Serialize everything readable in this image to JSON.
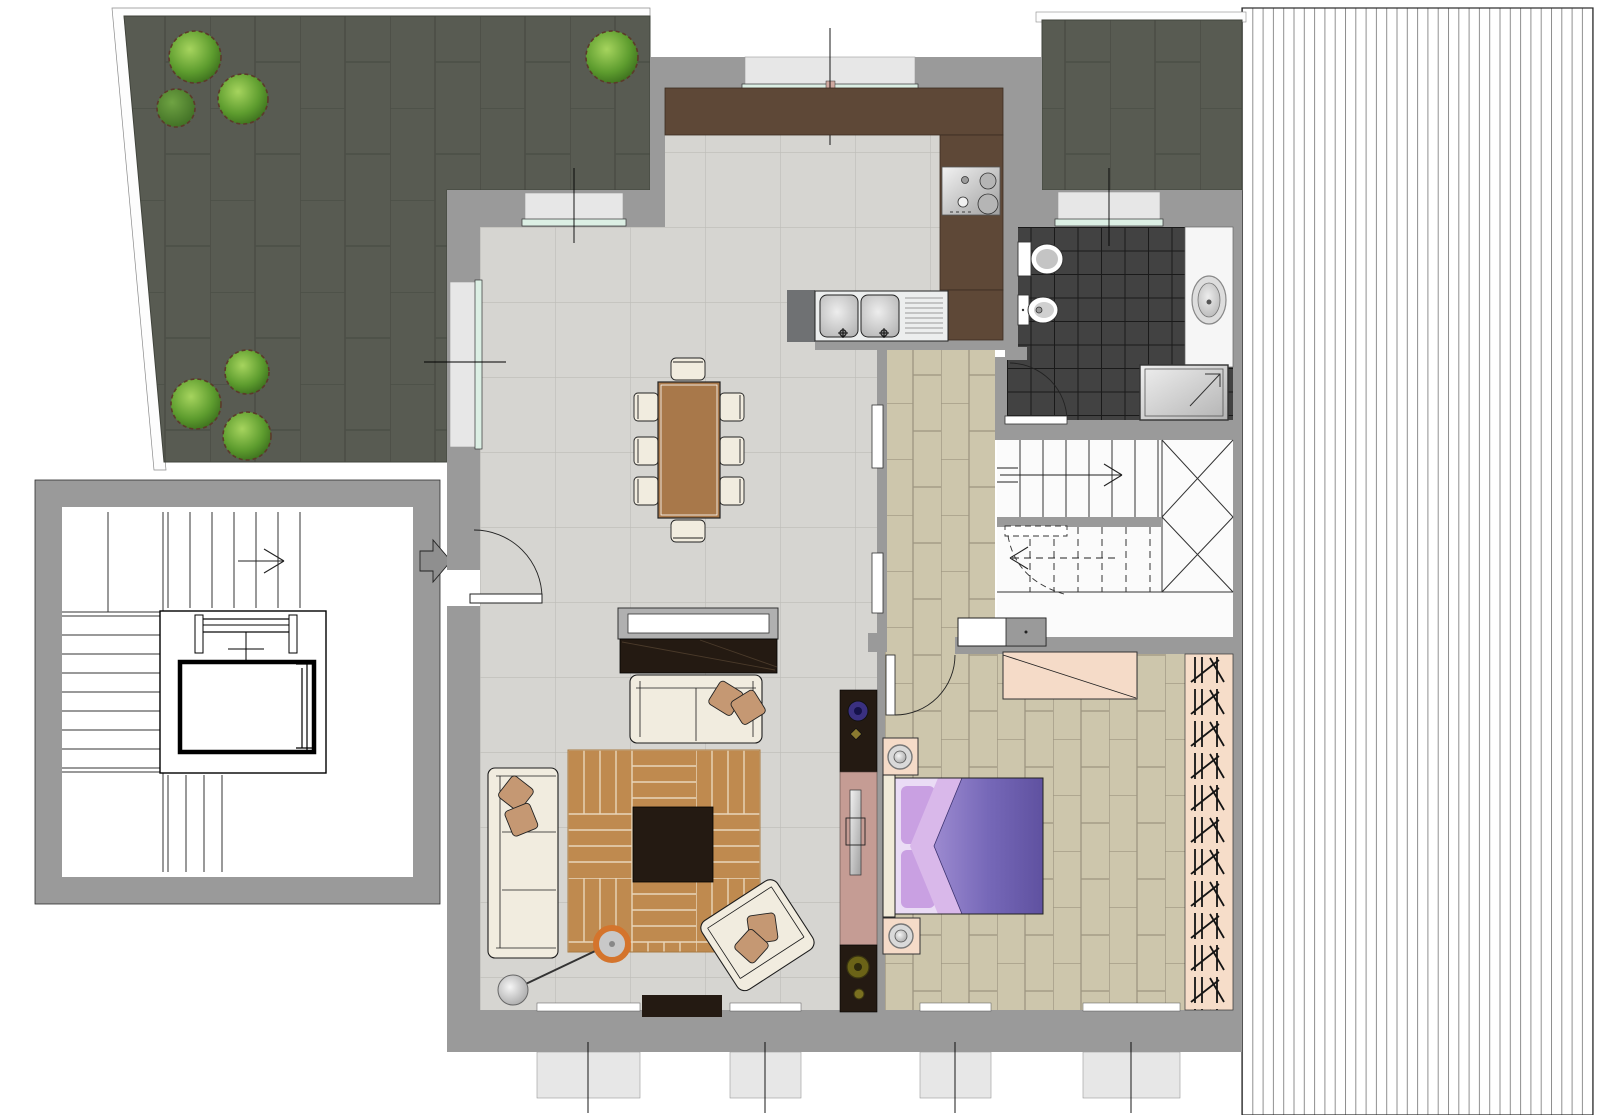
{
  "document": {
    "kind": "architectural-floor-plan",
    "view": "top-down apartment plan with furnishings",
    "canvas_px": {
      "width": 1598,
      "height": 1115
    },
    "visible_text": []
  },
  "palette": {
    "wall": "#9a9a9a",
    "wall_dark": "#6f7173",
    "terrace_tile": "#585b52",
    "terrace_grout": "#4b4e46",
    "floor_tile": "#d6d5d1",
    "floor_grout": "#bdbcb7",
    "brick_floor": "#cdc6ac",
    "brick_grout": "#9d9580",
    "bath_tile": "#424242",
    "bath_grout": "#1a1a1a",
    "kitchen_counter": "#5e4837",
    "table_wood": "#a8784a",
    "rug_wood": "#bf8a4f",
    "rug_line": "#e9d6ba",
    "dark_furniture": "#241a12",
    "sofa_cream": "#f1ecdf",
    "pillow": "#c59873",
    "window_glass": "#dcefe4",
    "window_sill": "#e7e7e7",
    "bedroom_peach": "#f5dbc8",
    "media_panel": "#c59c94",
    "wardrobe_bg": "#f6ddc9",
    "plant_green": "#4e8b26",
    "bed_duvet": "#5f51a0",
    "bed_pillow": "#c9a0e2",
    "lamp_accent": "#d4742c",
    "roof_stripe": "#8f8f8f"
  },
  "areas": [
    {
      "id": "upper-terrace",
      "floor": "dark paving tiles",
      "features": [
        "7 shrubs/planters"
      ]
    },
    {
      "id": "right-terrace",
      "floor": "dark paving tiles"
    },
    {
      "id": "roof-deck",
      "floor": "striped decking"
    },
    {
      "id": "common-stairwell",
      "features": [
        "wrap-around stairs",
        "elevator",
        "entry-arrow"
      ]
    },
    {
      "id": "living-dining-room",
      "floor": "light ceramic tile"
    },
    {
      "id": "kitchen",
      "floor": "light ceramic tile"
    },
    {
      "id": "hallway",
      "floor": "beige brick tile"
    },
    {
      "id": "bathroom",
      "floor": "dark mosaic tile"
    },
    {
      "id": "internal-staircase",
      "features": [
        "two flights",
        "winder treads",
        "direction arrows"
      ]
    },
    {
      "id": "bedroom",
      "floor": "beige brick tile"
    },
    {
      "id": "wardrobe-closet",
      "features": [
        "hanging-rail hatching"
      ]
    }
  ],
  "fixtures": {
    "kitchen": [
      "L-shaped counter",
      "cooktop-4-burners",
      "double-sink-with-drainboard"
    ],
    "dining": [
      "rectangular table",
      "8 chairs"
    ],
    "living": [
      "tv-screen",
      "tv-cabinet",
      "two-seat sofa",
      "three-seat sofa",
      "armchair",
      "parquet area rug",
      "coffee table",
      "floor lamp",
      "door mat",
      "media-fireplace wall unit"
    ],
    "bathroom": [
      "toilet",
      "bidet",
      "washbasin counter",
      "shower",
      "door"
    ],
    "bedroom": [
      "double bed",
      "2 nightstands with lamps",
      "dresser",
      "door"
    ],
    "openings": [
      "entry door with swing",
      "4 bottom windows",
      "kitchen window",
      "2 terrace windows",
      "bathroom window",
      "2 hallway sliding panels"
    ]
  },
  "counts": {
    "plants": 7,
    "dining_chairs": 8,
    "bottom_windows": 4,
    "stair_flights_internal": 2
  }
}
